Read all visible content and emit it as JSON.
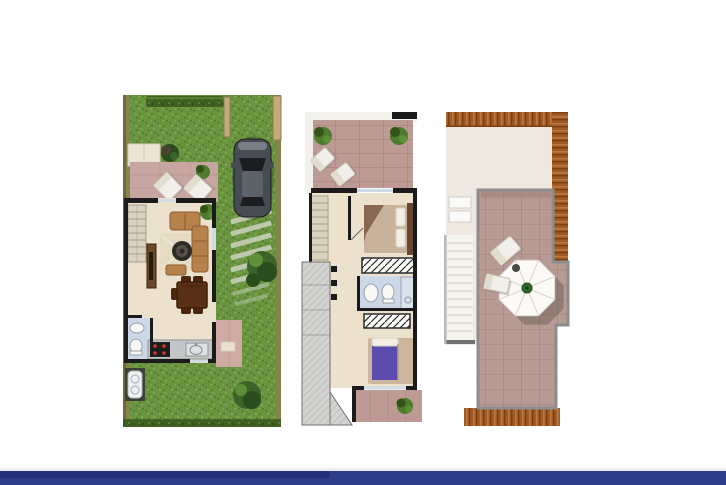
{
  "scene": {
    "type": "real-estate-floor-plan-collage",
    "plans": [
      {
        "name": "ground-floor-plan-with-garden-and-parking"
      },
      {
        "name": "first-floor-plan"
      },
      {
        "name": "roof-solarium-plan"
      }
    ],
    "objects": {
      "ground_floor": [
        "garden-lawn",
        "hedge",
        "fence",
        "parked-car",
        "driveway-slats",
        "terrace-lounge-chairs",
        "living-room-sofa",
        "coffee-table",
        "tv-unit",
        "dining-table",
        "kitchen-counter",
        "stove",
        "sink",
        "bathroom",
        "porch",
        "bushes",
        "ac-unit",
        "stairs"
      ],
      "first_floor": [
        "front-terrace",
        "potted-plants",
        "lounge-chairs",
        "bedroom-1-bed",
        "wardrobes",
        "bathroom",
        "shower",
        "bedroom-2-bed",
        "rear-terrace",
        "stairs"
      ],
      "roof": [
        "clay-tile-roof-edges",
        "lower-roof",
        "skylight-stairwell",
        "solarium-terrace",
        "parasol-table",
        "lounge-chairs"
      ]
    }
  },
  "footer": {
    "bar": "navy-brand-bar"
  },
  "palette": {
    "page-bg": "#ffffff",
    "grass": "#6b9440",
    "grass-dark": "#597e2f",
    "grass-light": "#7ea64e",
    "hedge": "#3f6022",
    "hedge-dark": "#2f4b18",
    "hedge-light": "#567f2c",
    "fence": "#85834b",
    "fence-dark": "#6c6a38",
    "post": "#c2ac7e",
    "post-dark": "#8f7c50",
    "terr1": "#c7a5a0",
    "terr1-grout": "#b18d87",
    "pad": "#ece5d6",
    "pad-stroke": "#d6cdb9",
    "floor": "#ebe1cc",
    "wall": "#1b1b1b",
    "stair": "#dad2c1",
    "stair-line": "#a79d88",
    "rug": "#e3d8c0",
    "sofa": "#b5824c",
    "sofa-dark": "#8a5c30",
    "coffee": "#2e2a26",
    "coffee-light": "#57504a",
    "tv": "#6b4a2b",
    "tv-dark": "#241a10",
    "table": "#5a3014",
    "table-dark": "#3c1f0a",
    "chair": "#4a280f",
    "counter": "#c3c7c7",
    "counter-line": "#8f9496",
    "stove": "#1d1d1d",
    "burner": "#cf3a2a",
    "sink": "#dde1e1",
    "bath": "#ccd8e7",
    "fixture": "#f8f8f6",
    "fixture-stroke": "#98a2ab",
    "porch": "#cfaaa3",
    "mat": "#e9e2d3",
    "ac-pad": "#3d4237",
    "ac": "#eef0f1",
    "ac-stroke": "#b3b9bb",
    "bush": "#3c632a",
    "bush-dark": "#2b4c1c",
    "bush-light": "#5d8f36",
    "plant-green": "#4e7b2e",
    "plant-dark": "#335417",
    "car-body": "#474c53",
    "car-dark": "#1b1d20",
    "car-mid": "#5c626a",
    "car-light": "#858b93",
    "slat": "#ccd2c1",
    "frame-white": "#f3f1ec",
    "terr2": "#bd9a94",
    "terr2-grout": "#a5827b",
    "glass": "#cfdce8",
    "glass-line": "#9fb6c9",
    "bed1": "#c9b29c",
    "bed1-dark": "#7c5a43",
    "headboard": "#684832",
    "pillow": "#f2eee5",
    "bed2": "#5b4cae",
    "bed2-frame": "#cdb69e",
    "ward-bg": "#fdfdfa",
    "ward-line": "#2b2b2b",
    "gray-area": "#d3d3d1",
    "gray-line": "#bebebc",
    "gray-edge": "#707070",
    "roof-pale": "#efe8e1",
    "roof-pale-line": "#ddd4ca",
    "rooftile": "#a05a24",
    "rooftile-dark": "#7b3f12",
    "rooftile-light": "#c8854a",
    "solar": "#b79a93",
    "solar-grout": "#a0817a",
    "solar-border": "#8d8d8d",
    "solar-shadow": "#9c7f78",
    "parasol": "#fbfaf7",
    "parasol-rib": "#d9d4ca",
    "parasol-shadow": "#57504a",
    "parasol-green": "#2e6b2d",
    "lounge": "#f1efe9",
    "lounge-stroke": "#c7c2b5",
    "lounge-shadow": "#8b857a",
    "navy": "#2e3a8a",
    "navy-dark": "#222d73",
    "hairline": "#e9eef7"
  }
}
